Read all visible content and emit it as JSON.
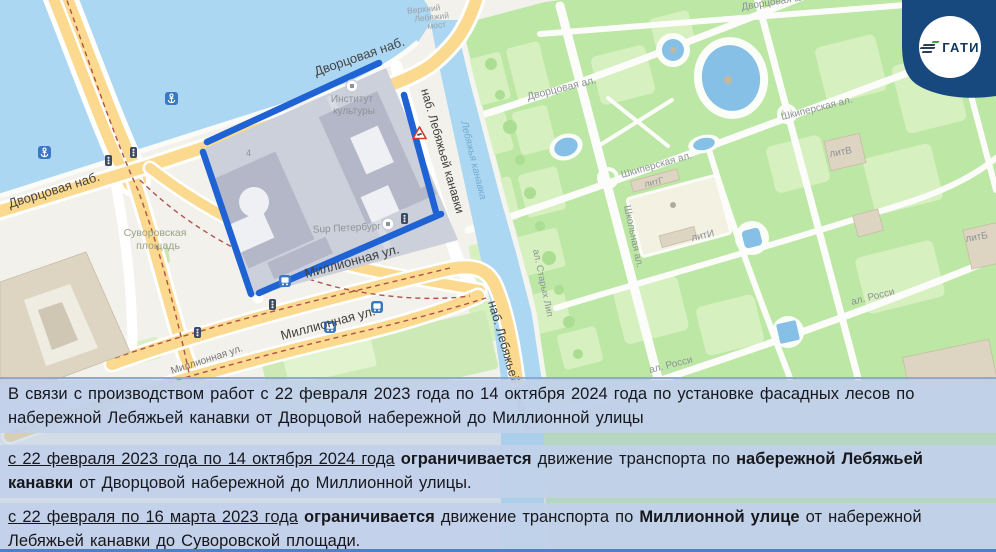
{
  "logo": {
    "text": "ГАТИ",
    "badge_color": "#17497f",
    "mark_green": "#3fa047",
    "mark_navy": "#2c3f55"
  },
  "panel": {
    "background": "#c2d1e9",
    "text_color": "#17181d",
    "paragraphs": [
      {
        "segments": [
          {
            "t": "В связи с производством работ с 22 февраля 2023 года по 14 октября 2024 года по установке фасадных лесов по набережной Лебяжьей канавки от Дворцовой набережной до Миллионной улицы"
          }
        ]
      },
      {
        "segments": [
          {
            "t": "с 22 февраля 2023 года по 14 октября 2024 года",
            "u": true
          },
          {
            "t": " "
          },
          {
            "t": "ограничивается",
            "b": true
          },
          {
            "t": " движение транспорта по "
          },
          {
            "t": "набережной Лебяжьей канавки",
            "b": true
          },
          {
            "t": " от Дворцовой набережной до Миллионной улицы."
          }
        ]
      },
      {
        "segments": [
          {
            "t": "с 22 февраля по 16 марта 2023 года",
            "u": true
          },
          {
            "t": " "
          },
          {
            "t": "ограничивается",
            "b": true
          },
          {
            "t": " движение транспорта по "
          },
          {
            "t": "Миллионной улице",
            "b": true
          },
          {
            "t": " от набережной Лебяжьей канавки до Суворовской площади."
          }
        ]
      }
    ]
  },
  "map": {
    "colors": {
      "water": "#abd7f2",
      "park": "#bde7a4",
      "park_light": "#d7f0bf",
      "road_yellow": "#fbd98e",
      "route_blue": "#1e62d4",
      "block": "#ccd0db",
      "building": "#b3b7c7",
      "beige": "#ddd5c2",
      "tram": "#b0524e",
      "land": "#f3f1eb"
    },
    "route_segments": [
      [
        207,
        142,
        379,
        63
      ],
      [
        203,
        152,
        251,
        294
      ],
      [
        404,
        95,
        436,
        212
      ],
      [
        259,
        293,
        441,
        214
      ]
    ],
    "labels": [
      {
        "t": "Дворцовая наб.",
        "x": 10,
        "y": 208,
        "r": -17,
        "s": 13,
        "c": "#454545"
      },
      {
        "t": "Дворцовая наб.",
        "x": 316,
        "y": 76,
        "r": -19,
        "s": 13,
        "c": "#454545"
      },
      {
        "t": "Верхний",
        "x": 424,
        "y": 12,
        "r": -6,
        "s": 8.5,
        "c": "#9aa0a6",
        "a": "middle"
      },
      {
        "t": "Лебяжий",
        "x": 432,
        "y": 20,
        "r": -6,
        "s": 8.5,
        "c": "#9aa0a6",
        "a": "middle"
      },
      {
        "t": "мост",
        "x": 437,
        "y": 28,
        "r": -6,
        "s": 8.5,
        "c": "#9aa0a6",
        "a": "middle"
      },
      {
        "t": "наб. Лебяжьей канавки",
        "x": 421,
        "y": 90,
        "r": 74,
        "s": 12,
        "c": "#3f3f3f"
      },
      {
        "t": "наб. Лебяжьей канавки",
        "x": 488,
        "y": 302,
        "r": 74,
        "s": 12.5,
        "c": "#3f3f3f"
      },
      {
        "t": "Миллионная ул.",
        "x": 306,
        "y": 278,
        "r": -15,
        "s": 13,
        "c": "#3f3f3f"
      },
      {
        "t": "Миллионная ул.",
        "x": 282,
        "y": 340,
        "r": -15,
        "s": 13,
        "c": "#3f3f3f"
      },
      {
        "t": "Миллионная ул.",
        "x": 172,
        "y": 374,
        "r": -18,
        "s": 10,
        "c": "#777777"
      },
      {
        "t": "Суворовская",
        "x": 155,
        "y": 236,
        "r": 0,
        "s": 10.5,
        "c": "#96a388",
        "a": "middle"
      },
      {
        "t": "площадь",
        "x": 158,
        "y": 249,
        "r": 0,
        "s": 10.5,
        "c": "#96a388",
        "a": "middle"
      },
      {
        "t": "Институт",
        "x": 352,
        "y": 102,
        "r": 0,
        "s": 10,
        "c": "#8d9297",
        "a": "middle"
      },
      {
        "t": "культуры",
        "x": 354,
        "y": 114,
        "r": 0,
        "s": 10,
        "c": "#8d9297",
        "a": "middle"
      },
      {
        "t": "Sup Петербург",
        "x": 347,
        "y": 231,
        "r": -3,
        "s": 10,
        "c": "#8d9297",
        "a": "middle"
      },
      {
        "t": "4",
        "x": 246,
        "y": 156,
        "r": 0,
        "s": 9,
        "c": "#8d9297"
      },
      {
        "t": "Лебяжья канавка",
        "x": 461,
        "y": 122,
        "r": 76,
        "s": 10,
        "c": "#74abd0",
        "i": true
      },
      {
        "t": "Дворцовая ал.",
        "x": 528,
        "y": 100,
        "r": -14,
        "s": 10.5,
        "c": "#8d9297"
      },
      {
        "t": "Дворцовая ал.",
        "x": 742,
        "y": 10,
        "r": -9,
        "s": 10,
        "c": "#8d9297"
      },
      {
        "t": "Шкиперская ал.",
        "x": 622,
        "y": 178,
        "r": -16,
        "s": 10,
        "c": "#8d9297"
      },
      {
        "t": "Шкиперская ал.",
        "x": 782,
        "y": 120,
        "r": -14,
        "s": 10,
        "c": "#8d9297"
      },
      {
        "t": "Школьная ал.",
        "x": 624,
        "y": 206,
        "r": 78,
        "s": 10,
        "c": "#8d9297"
      },
      {
        "t": "ал. Старых Лип",
        "x": 533,
        "y": 250,
        "r": 78,
        "s": 9.5,
        "c": "#8d9297"
      },
      {
        "t": "ал. Росси",
        "x": 852,
        "y": 305,
        "r": -14,
        "s": 10,
        "c": "#8d9297"
      },
      {
        "t": "ал. Росси",
        "x": 650,
        "y": 373,
        "r": -14,
        "s": 10,
        "c": "#8d9297"
      },
      {
        "t": "литВ",
        "x": 830,
        "y": 157,
        "r": -10,
        "s": 10,
        "c": "#8d9297"
      },
      {
        "t": "литГ",
        "x": 645,
        "y": 187,
        "r": -12,
        "s": 9,
        "c": "#8d9297"
      },
      {
        "t": "литИ",
        "x": 692,
        "y": 241,
        "r": -12,
        "s": 10,
        "c": "#8d9297"
      },
      {
        "t": "литБ",
        "x": 966,
        "y": 242,
        "r": -10,
        "s": 10,
        "c": "#8d9297"
      }
    ],
    "icons": [
      {
        "name": "anchor-icon",
        "x": 38,
        "y": 146
      },
      {
        "name": "anchor-icon",
        "x": 165,
        "y": 92
      },
      {
        "name": "traffic-light-icon",
        "x": 105,
        "y": 155
      },
      {
        "name": "traffic-light-icon",
        "x": 130,
        "y": 147
      },
      {
        "name": "traffic-light-icon",
        "x": 194,
        "y": 327
      },
      {
        "name": "traffic-light-icon",
        "x": 269,
        "y": 299
      },
      {
        "name": "traffic-light-icon",
        "x": 401,
        "y": 213
      },
      {
        "name": "bus-stop-icon",
        "x": 324,
        "y": 321
      },
      {
        "name": "bus-stop-icon",
        "x": 371,
        "y": 301
      },
      {
        "name": "bus-stop-icon",
        "x": 279,
        "y": 275
      },
      {
        "name": "roadwork-warning-icon",
        "x": 413,
        "y": 127
      },
      {
        "name": "poi-circle-icon",
        "x": 346,
        "y": 80
      },
      {
        "name": "poi-circle-icon",
        "x": 382,
        "y": 218
      }
    ]
  }
}
